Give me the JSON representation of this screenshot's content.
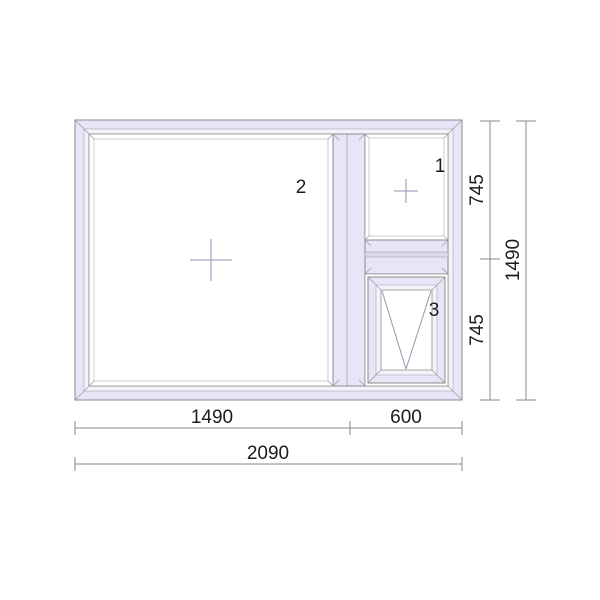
{
  "drawing": {
    "type": "window-elevation-drawing",
    "pane_labels": {
      "left": "2",
      "top_right": "1",
      "bottom_right": "3"
    },
    "pane_openings": {
      "left": "fixed",
      "top_right": "fixed",
      "bottom_right": "tilt"
    },
    "dimensions": {
      "left_width": "1490",
      "right_width": "600",
      "total_width": "2090",
      "top_right_height": "745",
      "bottom_right_height": "745",
      "total_height": "1490"
    },
    "icons": {
      "glass_center_marker": "cross",
      "tilt_indicator": "v-lines"
    },
    "colors": {
      "background": "#ffffff",
      "frame_fill": "#e6e6f6",
      "frame_highlight": "#f3f3fb",
      "frame_stroke": "#8b8b8b",
      "glass_fill": "#ffffff",
      "marker_stroke": "#a3abc4",
      "tilt_indicator_stroke": "#9298ab",
      "dimension_stroke": "#8a8a8a",
      "label_text": "#1c1c1c"
    }
  }
}
